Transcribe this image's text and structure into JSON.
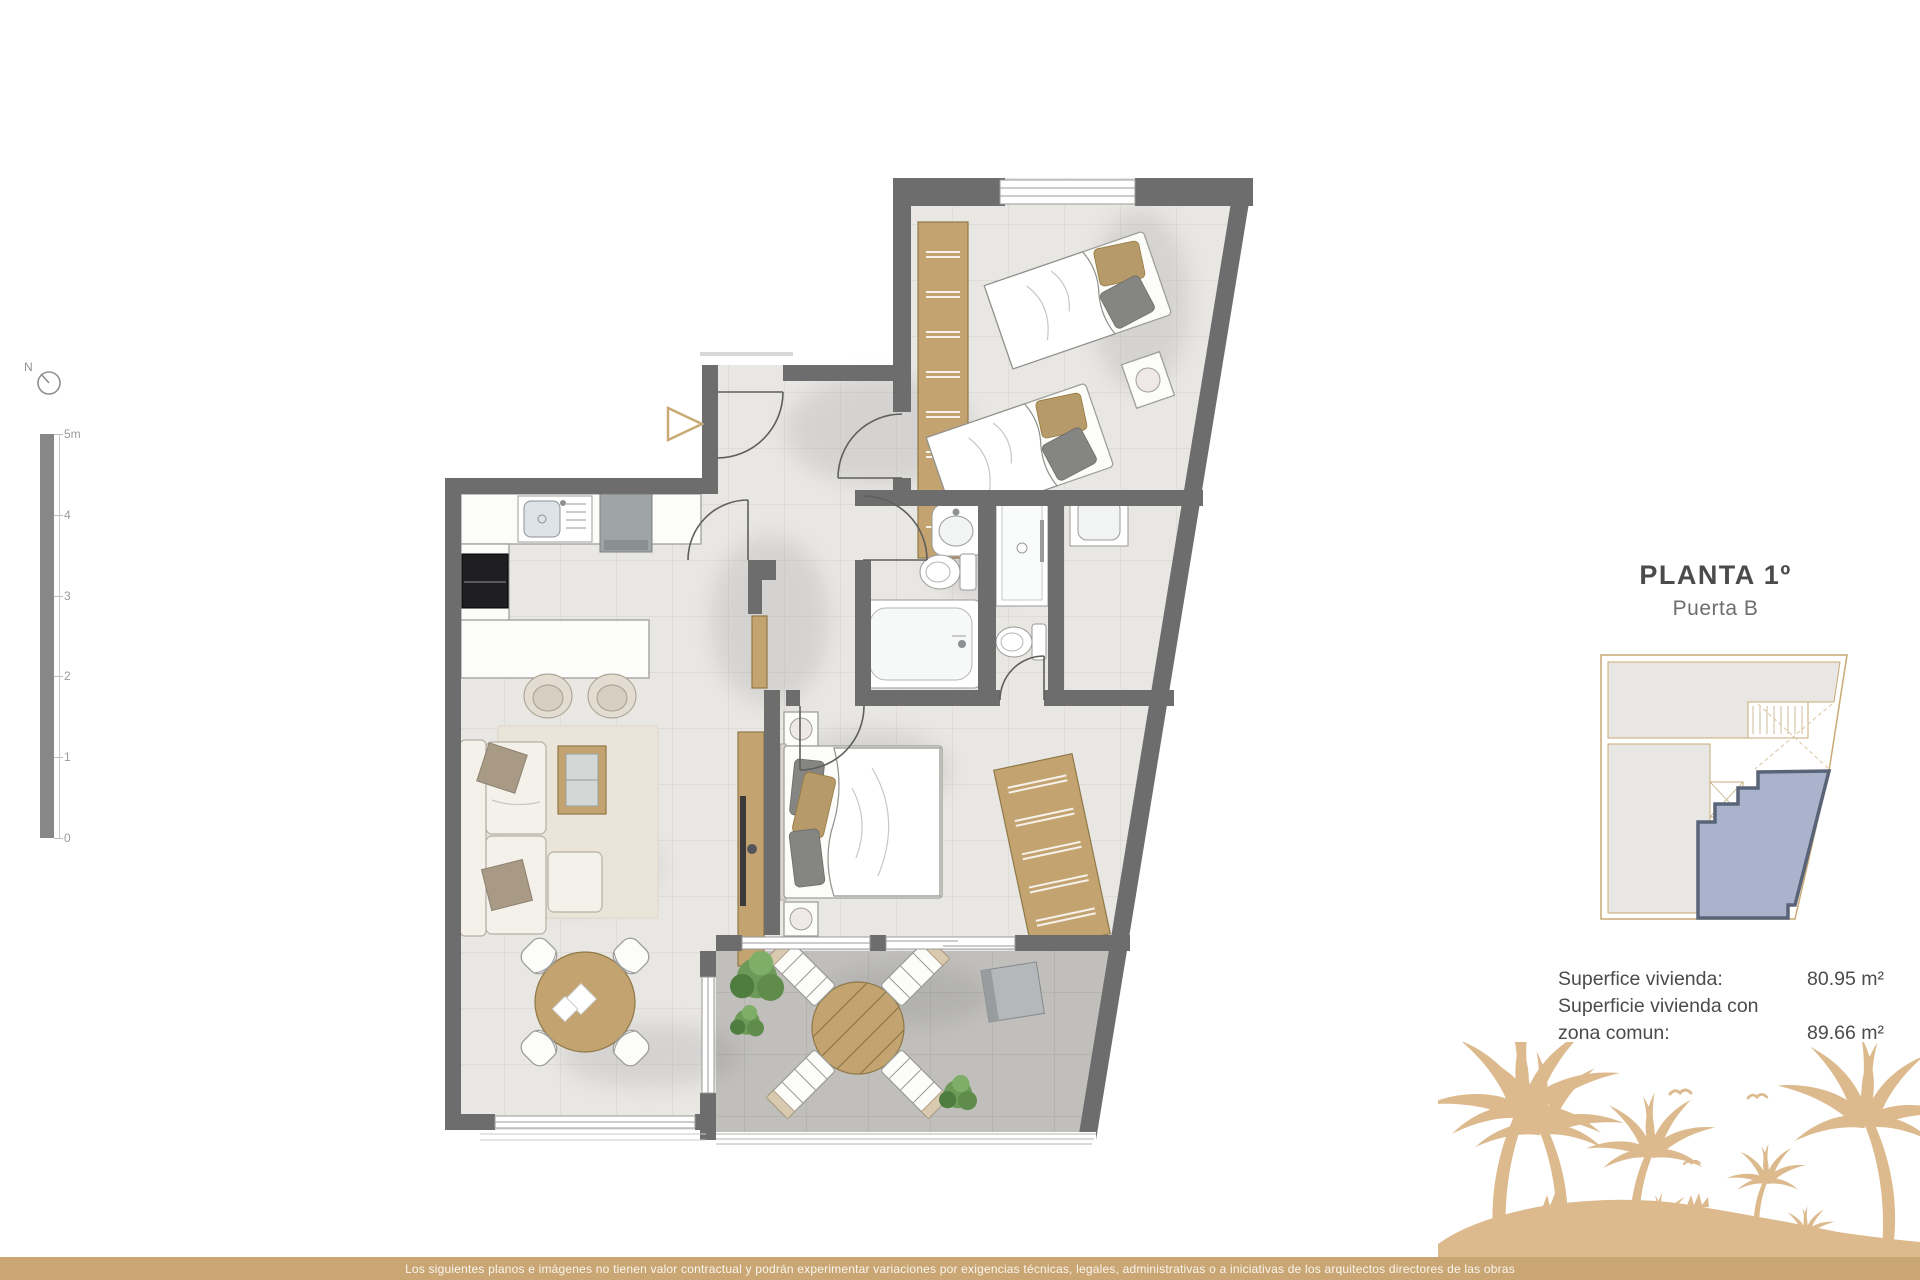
{
  "compass": {
    "label": "N"
  },
  "scalebar": {
    "labels": [
      "5m",
      "4",
      "3",
      "2",
      "1",
      "0"
    ]
  },
  "info_panel": {
    "title": "PLANTA 1º",
    "subtitle": "Puerta B",
    "area_rows": [
      {
        "label": "Superfice vivienda:",
        "value": "80.95 m²"
      },
      {
        "label": "Superficie vivienda con",
        "value": ""
      },
      {
        "label": "zona comun:",
        "value": "89.66 m²"
      }
    ]
  },
  "footer": {
    "disclaimer": "Los siguientes planos e imágenes no tienen valor contractual y podrán experimentar variaciones por exigencias técnicas, legales, administrativas o a iniciativas de los arquitectos directores de las obras"
  },
  "colors": {
    "wall": "#6d6d6d",
    "floor": "#e9e7e4",
    "floor-line": "#d9d6d2",
    "terrace-floor": "#c0bfbc",
    "terrace-line": "#adacaa",
    "wood": "#c3a471",
    "wood-dark": "#8f7848",
    "accent": "#c9a974",
    "palm": "#dcba8e",
    "bar": "#c9a673",
    "unit-fill": "#a9b3cb",
    "unit-stroke": "#5a6478",
    "text-dark": "#4b4b4d",
    "text-mid": "#6e6e70"
  }
}
